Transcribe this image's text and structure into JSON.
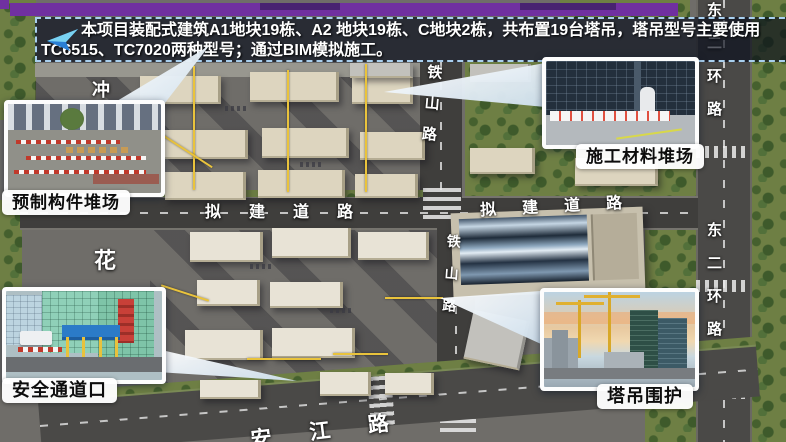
{
  "topbar": {
    "color": "#7030a0"
  },
  "banner": {
    "icon": "paper-plane-arrow",
    "line1": "本项目装配式建筑A1地块19栋、A2 地块19栋、C地块2栋，共布置19台塔吊，塔吊型号主要使用",
    "line2": "TC6515、TC7020两种型号；通过BIM模拟施工。",
    "border_color": "#a8cfee"
  },
  "callouts": [
    {
      "id": "precast-component-yard",
      "label": "预制构件堆场"
    },
    {
      "id": "construction-material-yard",
      "label": "施工材料堆场"
    },
    {
      "id": "safety-passage-entrance",
      "label": "安全通道口"
    },
    {
      "id": "tower-crane-enclosure",
      "label": "塔吊围护"
    }
  ],
  "map_labels": {
    "tieshan_road_upper": "铁山路",
    "tieshan_road_lower": "铁山路",
    "proposed_road_west": "拟建道路",
    "proposed_road_east": "拟建道路",
    "east_ring_road_top": "东二环路",
    "east_ring_road_bottom": "东二环路",
    "hua": "花",
    "chong": "冲",
    "anjiang_road": "安江路"
  },
  "colors": {
    "crane_yellow": "#e9c33c",
    "building_beige": "#ddd5bf",
    "vegetation_green": "#6e7f44",
    "road_gray": "#4a4947"
  }
}
